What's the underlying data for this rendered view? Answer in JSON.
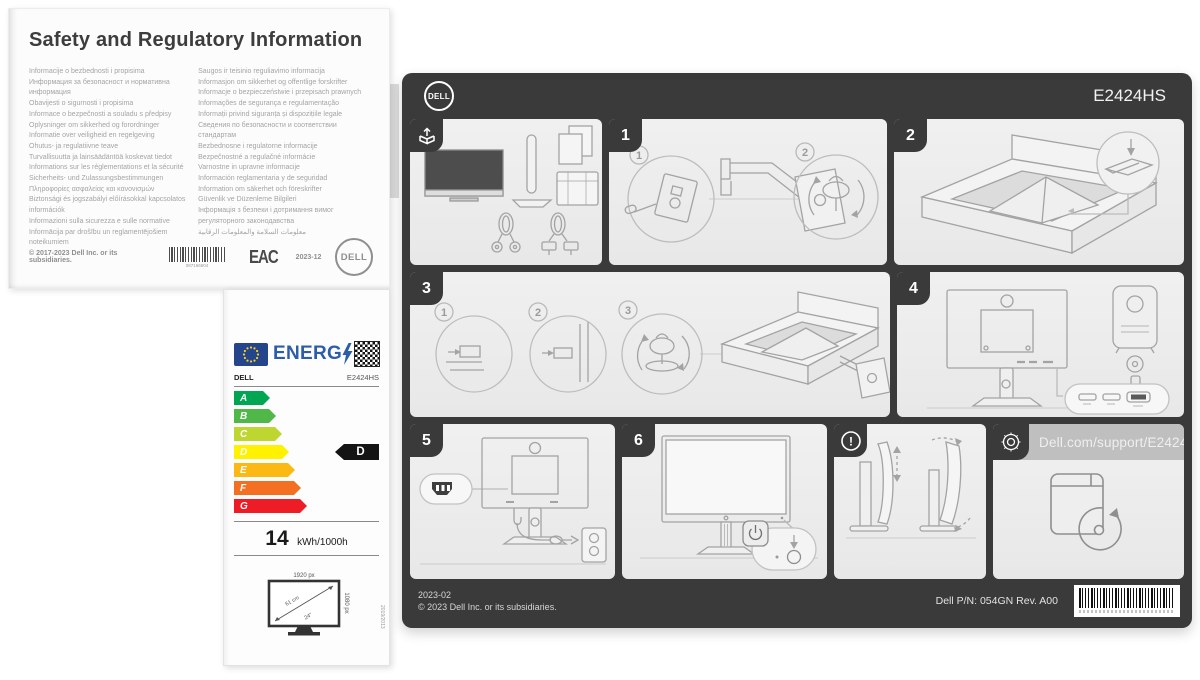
{
  "colors": {
    "poster_background": "#3a3a3a",
    "panel_background": "#ececec",
    "energy_blue": "#2d5da8",
    "eu_flag_blue": "#24448c",
    "eu_star_yellow": "#f8d117",
    "rating_indicator_black": "#141414"
  },
  "safety_sheet": {
    "title": "Safety and Regulatory Information",
    "left_column": [
      "Informacije o bezbednosti i propisima",
      "Информация за безопасност и нормативна",
      "информация",
      "Obavijesti o sigurnosti i propisima",
      "Informace o bezpečnosti a souladu s předpisy",
      "Oplysninger om sikkerhed og forordninger",
      "Informatie over veiligheid en regelgeving",
      "Ohutus- ja regulatiivne teave",
      "Turvallisuutta ja lainsäädäntöä koskevat tiedot",
      "Informations sur les réglementations et la sécurité",
      "Sicherheits- und Zulassungsbestimmungen",
      "Πληροφορίες ασφαλείας και κανονισμών",
      "Biztonsági és jogszabályi előírásokkal kapcsolatos",
      "információk",
      "Informazioni sulla sicurezza e sulle normative",
      "Informācija par drošību un reglamentējošiem",
      "noteikumiem"
    ],
    "right_column": [
      "Saugos ir teisinio reguliavimo informacija",
      "Informasjon om sikkerhet og offentlige forskrifter",
      "Informacje o bezpieczeństwie i przepisach prawnych",
      "Informações de segurança e regulamentação",
      "Informații privind siguranța și dispozițiile legale",
      "Сведения по безопасности и соответствии",
      "стандартам",
      "Bezbednosne i regulatorne informacije",
      "Bezpečnostné a regulačné informácie",
      "Varnostne in upravne informacije",
      "Información reglamentaria y de seguridad",
      "Information om säkerhet och föreskrifter",
      "Güvenlik ve Düzenleme Bilgileri",
      "Інформація з безпеки і дотримання вимог",
      "регуляторного законодавства",
      "معلومات السلامة والمعلومات الرقابية"
    ],
    "copyright": "© 2017-2023 Dell Inc. or its subsidiaries.",
    "barcode_number": "087166604",
    "eac_mark": "EAC",
    "date_code": "2023-12",
    "logo_text": "DELL"
  },
  "energy_label": {
    "energ_word": "ENERG",
    "brand": "DELL",
    "model": "E2424HS",
    "ratings": [
      {
        "letter": "A",
        "color": "#00a651",
        "width": 36
      },
      {
        "letter": "B",
        "color": "#50b848",
        "width": 42
      },
      {
        "letter": "C",
        "color": "#bed630",
        "width": 48
      },
      {
        "letter": "D",
        "color": "#fff200",
        "width": 55
      },
      {
        "letter": "E",
        "color": "#fdb913",
        "width": 61
      },
      {
        "letter": "F",
        "color": "#f36f21",
        "width": 67
      },
      {
        "letter": "G",
        "color": "#ee1c25",
        "width": 73
      }
    ],
    "selected_rating": "D",
    "consumption_value": "14",
    "consumption_unit": "kWh/1000h",
    "screen_width": "1920 px",
    "screen_height": "1080 px",
    "diagonal_cm": "61 cm",
    "diagonal_inch": "24\"",
    "regulation": "2019/2013"
  },
  "poster": {
    "logo_text": "DELL",
    "model": "E2424HS",
    "panels": {
      "step1": {
        "number": "1",
        "callouts": [
          "1",
          "2"
        ]
      },
      "step2": {
        "number": "2"
      },
      "step3": {
        "number": "3",
        "callouts": [
          "1",
          "2",
          "3"
        ]
      },
      "step4": {
        "number": "4"
      },
      "step5": {
        "number": "5"
      },
      "step6": {
        "number": "6"
      },
      "warning": {
        "symbol": "!"
      },
      "support": {
        "url": "Dell.com/support/E2424HS"
      }
    },
    "footer": {
      "date_code": "2023-02",
      "copyright": "© 2023 Dell Inc. or its subsidiaries.",
      "part_number": "Dell P/N: 054GN Rev. A00"
    }
  }
}
